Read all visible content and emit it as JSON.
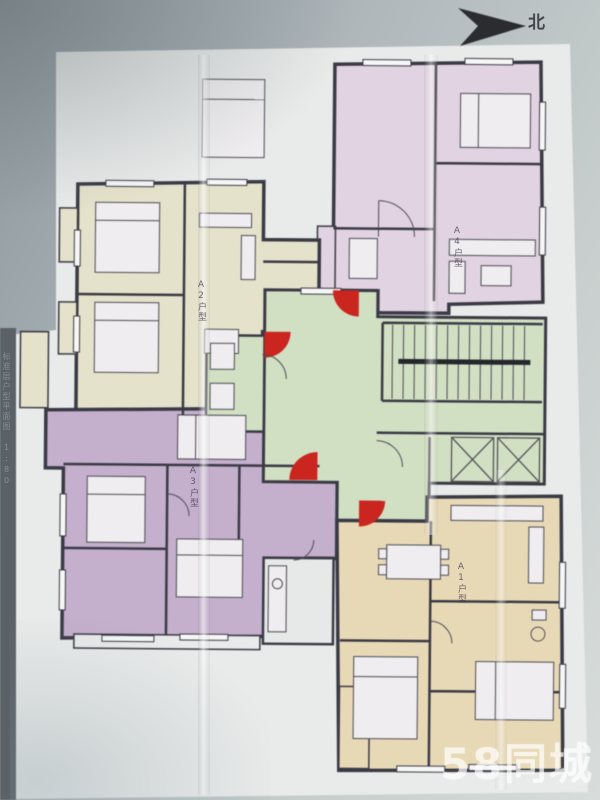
{
  "photo": {
    "watermark": "58同城",
    "compass_label": "北",
    "caption_vertical": "标准层户型平面图 1:80"
  },
  "units": {
    "a1": {
      "label": "A1户型",
      "color": "#eddcb5",
      "position": "bottom-right"
    },
    "a2": {
      "label": "A2户型",
      "color": "#e9e5cb",
      "position": "top-left"
    },
    "a3": {
      "label": "A3户型",
      "color": "#c7b0d1",
      "position": "middle-left"
    },
    "a4": {
      "label": "A4户型",
      "color": "#e5d5e5",
      "position": "top-right"
    },
    "core": {
      "color": "#d3e2c2",
      "position": "center-stair-core"
    }
  },
  "colors": {
    "wall": "#383844",
    "fire_door_red": "#d82018",
    "paper": "#eceeed",
    "photo_edge_strip": "#586067",
    "handrail": "#23232b"
  }
}
